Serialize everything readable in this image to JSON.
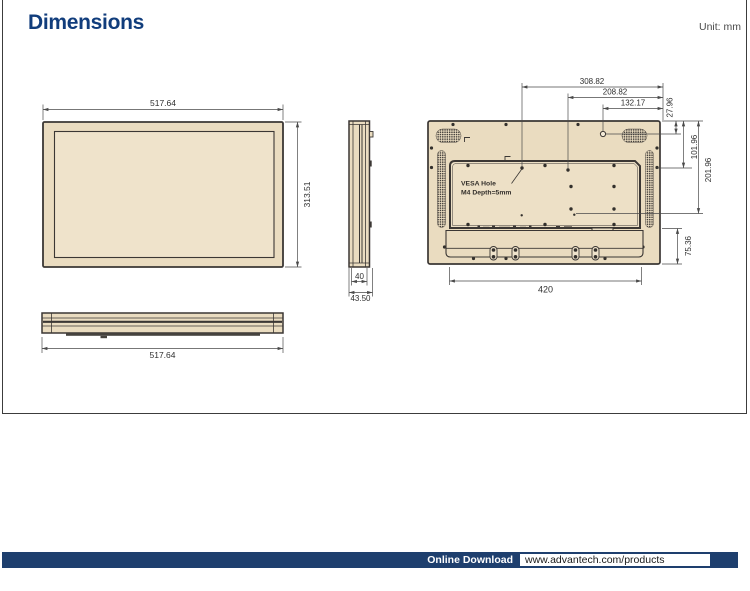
{
  "header": {
    "title": "Dimensions",
    "unit_label": "Unit: mm"
  },
  "views": {
    "front": {
      "width": "517.64",
      "height": "313.51"
    },
    "side": {
      "depth_body": "40",
      "depth_total": "43.50"
    },
    "rear": {
      "vesa_note_1": "VESA Hole",
      "vesa_note_2": "M4 Depth=5mm",
      "top_dims": {
        "d1": "308.82",
        "d2": "208.82",
        "d3": "132.17"
      },
      "right_dims": {
        "d1": "27.96",
        "d2": "101.96",
        "d3": "201.96",
        "d4": "75.36"
      },
      "bottom_dim": "420"
    },
    "bottom": {
      "width": "517.64"
    }
  },
  "footer": {
    "label": "Online Download",
    "url": "www.advantech.com/products"
  },
  "colors": {
    "title_navy": "#113D7C",
    "footer_navy": "#1E3F6E",
    "drawing_fill": "#EADCC0",
    "outline": "#3B3734",
    "dim_line": "#4a4a4a"
  }
}
